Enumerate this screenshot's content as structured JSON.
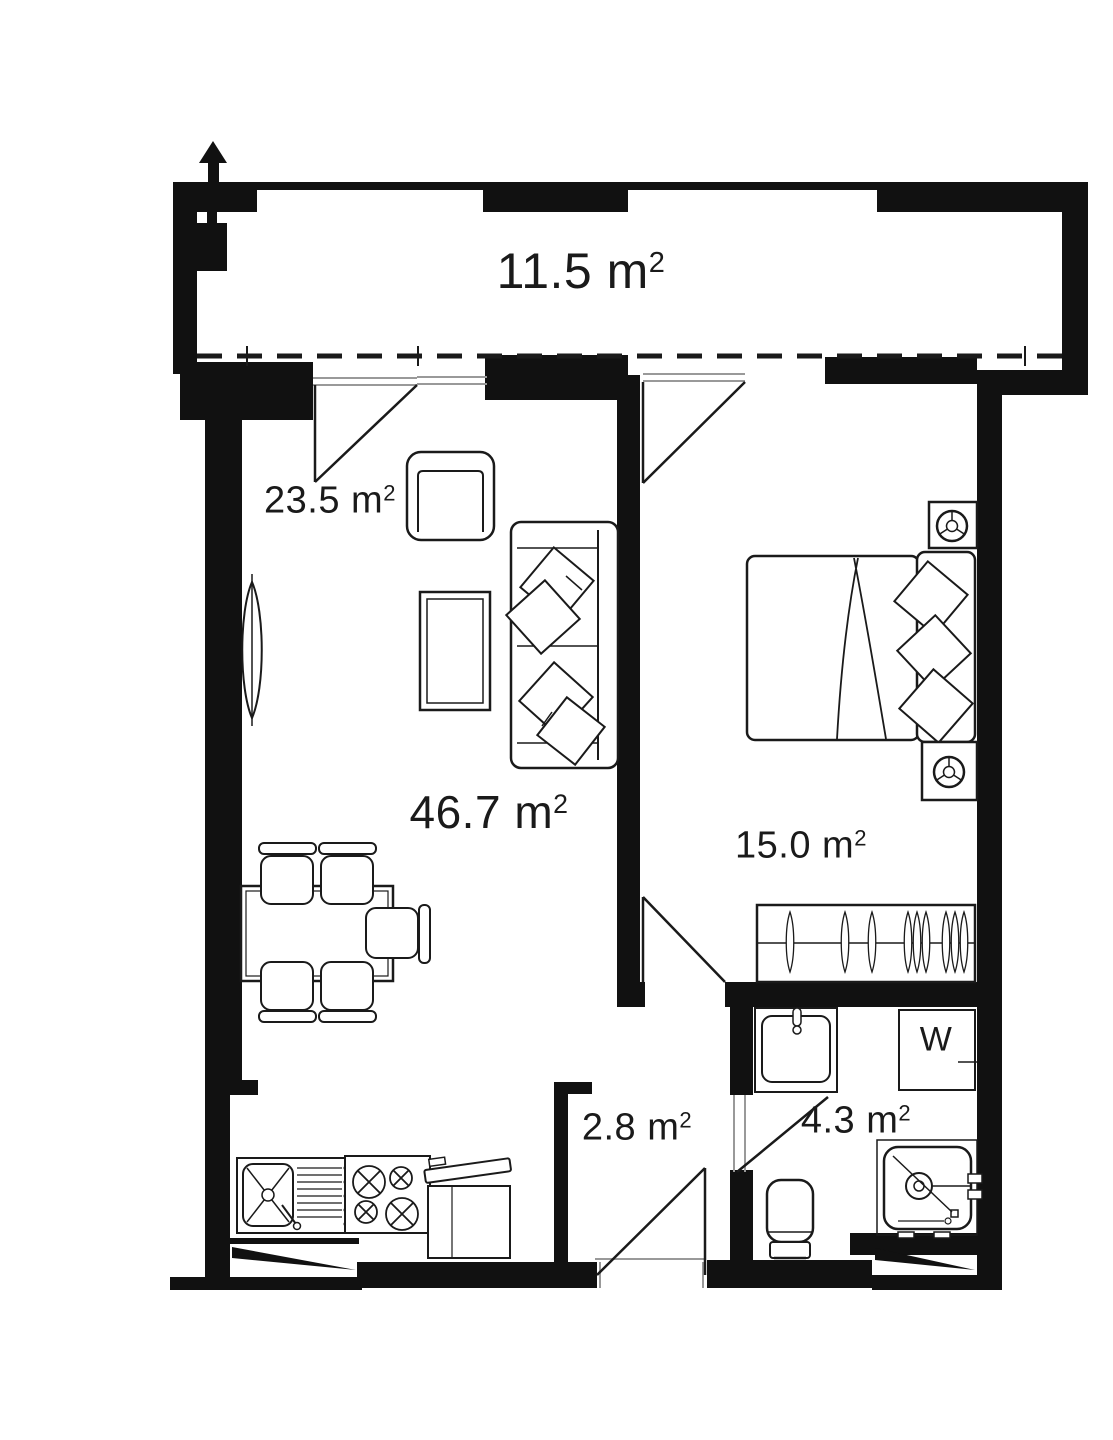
{
  "rooms": {
    "balcony": {
      "area": "11.5 m",
      "sup": "2"
    },
    "living_zone": {
      "area": "23.5 m",
      "sup": "2"
    },
    "living_total": {
      "area": "46.7 m",
      "sup": "2"
    },
    "bedroom": {
      "area": "15.0 m",
      "sup": "2"
    },
    "hallway": {
      "area": "2.8 m",
      "sup": "2"
    },
    "bathroom": {
      "area": "4.3 m",
      "sup": "2"
    }
  },
  "appliances": {
    "washer_label": "W"
  },
  "colors": {
    "walls": "#111111",
    "lines": "#1a1a1a",
    "window_lines": "#999999",
    "background": "#ffffff"
  }
}
